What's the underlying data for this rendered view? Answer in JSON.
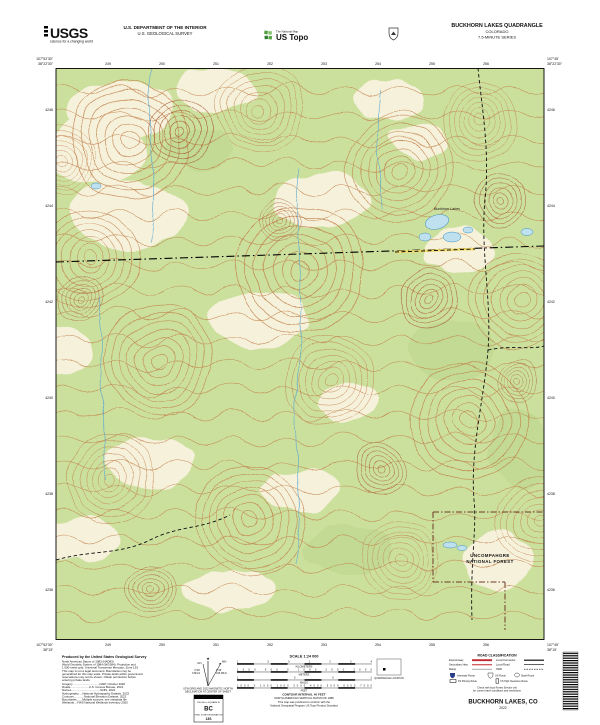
{
  "header": {
    "usgs_logo": "USGS",
    "usgs_tagline": "science for a changing world",
    "agency_line1": "U.S. DEPARTMENT OF THE INTERIOR",
    "agency_line2": "U.S. GEOLOGICAL SURVEY",
    "natmap_small": "The National Map",
    "ustopo_big": "US Topo",
    "quad_title": "BUCKHORN LAKES QUADRANGLE",
    "quad_state": "COLORADO",
    "quad_series": "7.5-MINUTE SERIES"
  },
  "map": {
    "corner_tl_lon": "107°52'30\"",
    "corner_tl_lat": "38°22'30\"",
    "corner_tr_lon": "107°45'",
    "corner_tr_lat": "38°22'30\"",
    "corner_bl_lon": "107°52'30\"",
    "corner_bl_lat": "38°15'",
    "corner_br_lon": "107°45'",
    "corner_br_lat": "38°15'",
    "ticks_top": [
      "249",
      "250",
      "251",
      "252",
      "253",
      "254",
      "255",
      "256"
    ],
    "ticks_bottom": [
      "249",
      "250",
      "251",
      "252",
      "253",
      "254",
      "255",
      "256"
    ],
    "ticks_left": [
      "4246",
      "4244",
      "4242",
      "4240",
      "4238",
      "4236"
    ],
    "ticks_right": [
      "4246",
      "4244",
      "4242",
      "4240",
      "4238",
      "4236"
    ],
    "labels": {
      "forest_line1": "UNCOMPAHGRE",
      "forest_line2": "NATIONAL FOREST",
      "lakes": "Buckhorn Lakes"
    },
    "colors": {
      "forest_green": "#CCE09E",
      "clearing": "#F6F1DB",
      "contour": "#C0804A",
      "contour_steep": "#A85A38",
      "water_fill": "#BFE0EF",
      "water_line": "#3F93C0",
      "boundary_red": "#6E3A28",
      "road_yellow": "#F2DC6B"
    }
  },
  "footer": {
    "produced_by": "Produced by the United States Geological Survey",
    "credits": [
      "North American Datum of 1983 (NAD83)",
      "World Geodetic System of 1984 (WGS84). Projection and",
      "1 000-meter grid: Universal Transverse Mercator, Zone 13S",
      "This map is not a legal document. Boundaries may be",
      "generalized for this map scale. Private lands within government",
      "reservations may not be shown. Obtain permission before",
      "entering private lands.",
      "Imagery..................................NAIP, October 2020",
      "Roads.......................U.S. Census Bureau, 2021",
      "Names....................................GNIS, 2022",
      "Hydrography.....National Hydrography Dataset, 2022",
      "Contours.............National Elevation Dataset, 2022",
      "Boundaries.......Multiple sources; see metadata file",
      "Wetlands....FWS National Wetlands Inventory 2020"
    ],
    "declination": {
      "star": "★",
      "gn_label": "GN",
      "mn_label": "MN",
      "gn_angle": "0°29'",
      "gn_mils": "9 MILS",
      "mn_angle": "9°16'",
      "mn_mils": "165 MILS",
      "caption1": "UTM GRID AND 2022 MAGNETIC NORTH",
      "caption2": "DECLINATION AT CENTER OF SHEET"
    },
    "usng": {
      "title": "U.S. NATIONAL GRID",
      "sq_label": "100,000-m SQUARE ID",
      "square": "BC",
      "gzd_label": "GRID ZONE DESIGNATION",
      "zone": "13S"
    },
    "scale": {
      "title": "SCALE 1:24 000",
      "km_nums": "1 .5 0 1 2 3 4",
      "km_label": "KILOMETERS",
      "m_nums": "1000 500 0 1000 2000 3000",
      "m_label": "METERS",
      "mi_nums": "1 .5 0 1",
      "mi_label": "MILES",
      "ft_nums": "1000 0 1000 2000 3000 4000 5000 6000 7000",
      "ft_label": "FEET",
      "contour_interval": "CONTOUR INTERVAL 40 FEET",
      "datum": "NORTH AMERICAN VERTICAL DATUM OF 1988",
      "standard1": "This map was produced to conform with the",
      "standard2": "National Geospatial Program US Topo Product Standard"
    },
    "quadloc_caption": "QUADRANGLE LOCATION",
    "road_classification": {
      "title": "ROAD CLASSIFICATION",
      "expressway": "Expressway",
      "local_connector": "Local Connector",
      "secondary": "Secondary Hwy",
      "local_road": "Local Road",
      "ramp": "Ramp",
      "fourwd": "4WD",
      "interstate": "Interstate Route",
      "us_route": "US Route",
      "state_route": "State Route",
      "fs_primary": "FS Primary Route",
      "fs_high": "FS High Clearance Route",
      "note1": "Check with local Forest Service unit",
      "note2": "for current travel conditions and restrictions"
    },
    "sheet_title": "BUCKHORN LAKES, CO",
    "sheet_year": "2022"
  }
}
